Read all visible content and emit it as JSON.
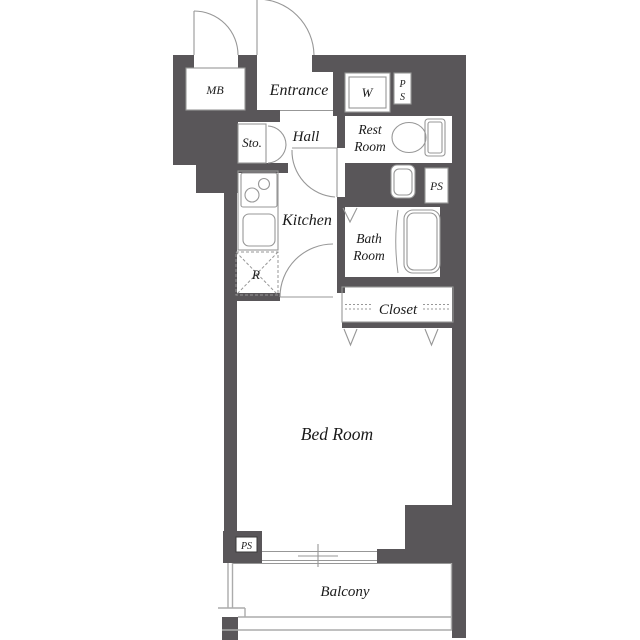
{
  "colors": {
    "wall": "#595659",
    "line": "#979797",
    "rail": "#ababab",
    "text": "#1a1a1a",
    "psline": "#3a3a3a",
    "bg": "#ffffff"
  },
  "labels": {
    "mb": "MB",
    "entrance": "Entrance",
    "washer": "W",
    "ps_top_p": "P",
    "ps_top_s": "S",
    "rest_line1": "Rest",
    "rest_line2": "Room",
    "sto": "Sto.",
    "hall": "Hall",
    "kitchen": "Kitchen",
    "ps_mid": "PS",
    "bath_line1": "Bath",
    "bath_line2": "Room",
    "fridge": "R",
    "closet": "Closet",
    "bedroom": "Bed Room",
    "ps_bottom": "PS",
    "balcony": "Balcony"
  }
}
